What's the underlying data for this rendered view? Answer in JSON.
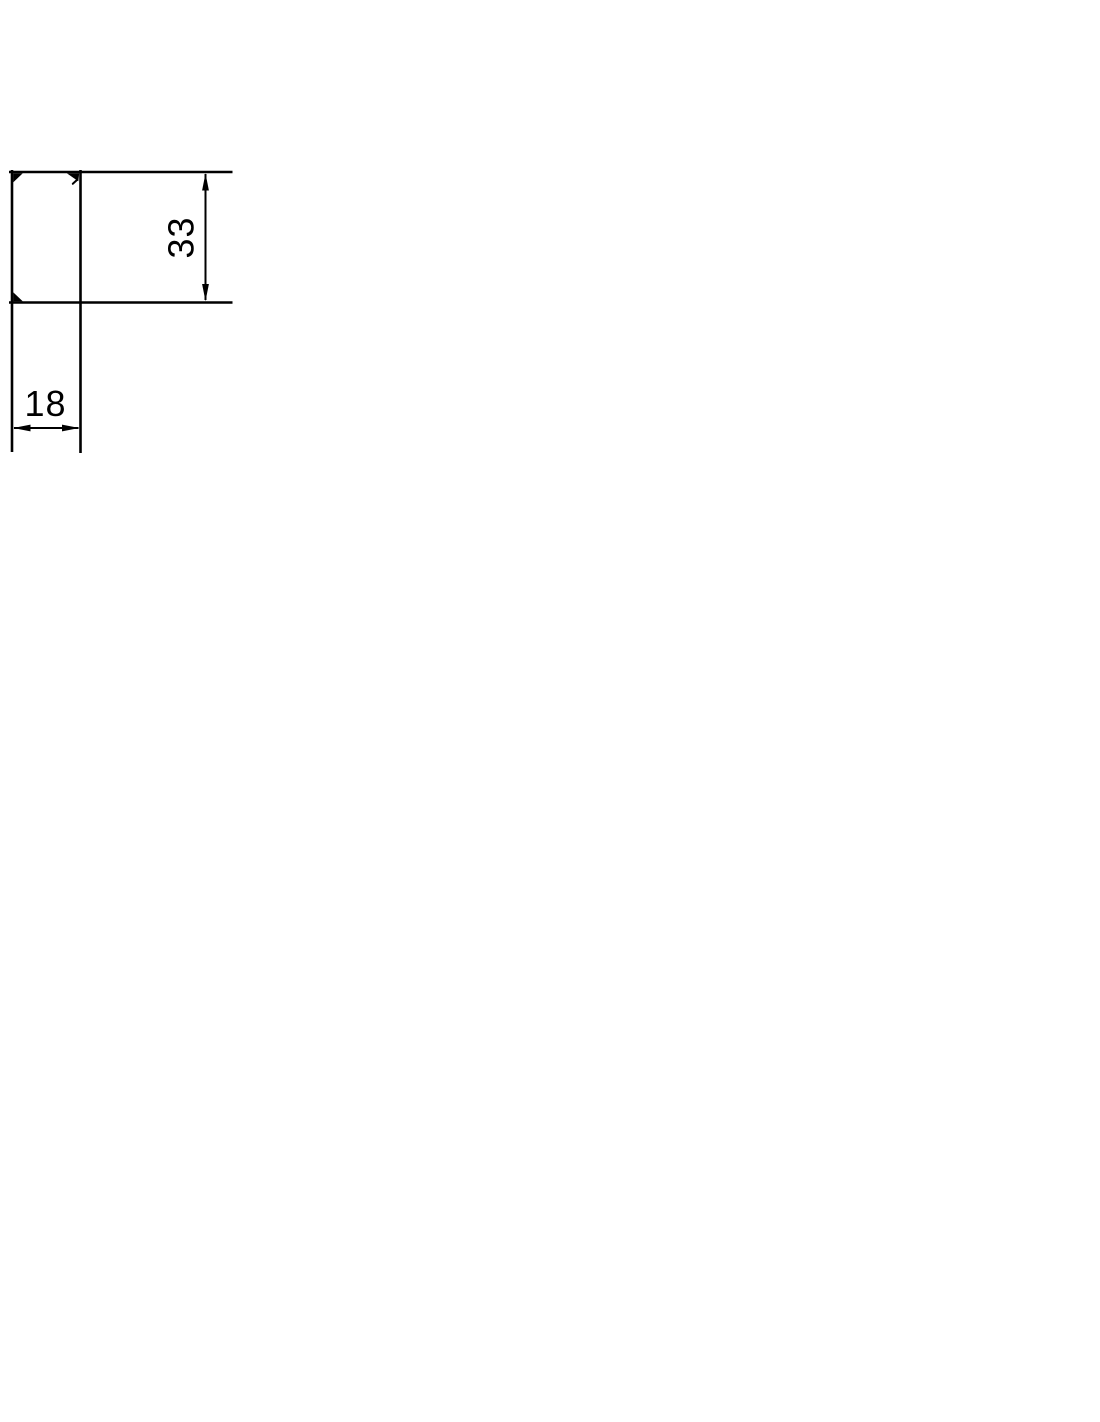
{
  "drawing": {
    "background_color": "#ffffff",
    "line_color": "#000000",
    "vertical_dimension": {
      "label": "33"
    },
    "horizontal_dimension": {
      "label": "18"
    }
  }
}
